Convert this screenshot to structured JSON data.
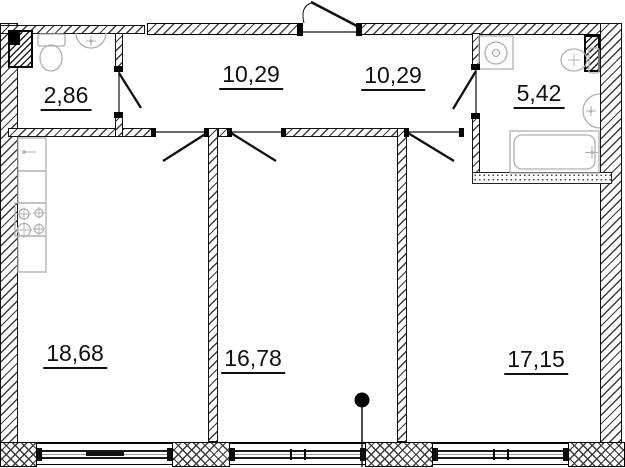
{
  "plan": {
    "type": "apartment-floor-plan",
    "area_unit": "m2",
    "rooms": [
      {
        "name": "wc",
        "area": "2,86"
      },
      {
        "name": "hallway-left",
        "area": "10,29"
      },
      {
        "name": "hallway-right",
        "area": "10,29"
      },
      {
        "name": "bathroom",
        "area": "5,42"
      },
      {
        "name": "kitchen-living",
        "area": "18,68"
      },
      {
        "name": "room-middle",
        "area": "16,78"
      },
      {
        "name": "room-right",
        "area": "17,15"
      }
    ],
    "fixtures": [
      "toilet",
      "wash-basin",
      "kitchen-sink",
      "kitchen-cabinets",
      "stove",
      "washing-machine",
      "bathtub",
      "ventilation-shaft-left",
      "ventilation-shaft-right"
    ],
    "markers": [
      "section-point-marker"
    ],
    "colors": {
      "wall_line": "#111111",
      "hatch": "#3c3c3c",
      "fixture_line": "#b0b0b0",
      "label": "#111111",
      "background": "#ffffff"
    }
  }
}
